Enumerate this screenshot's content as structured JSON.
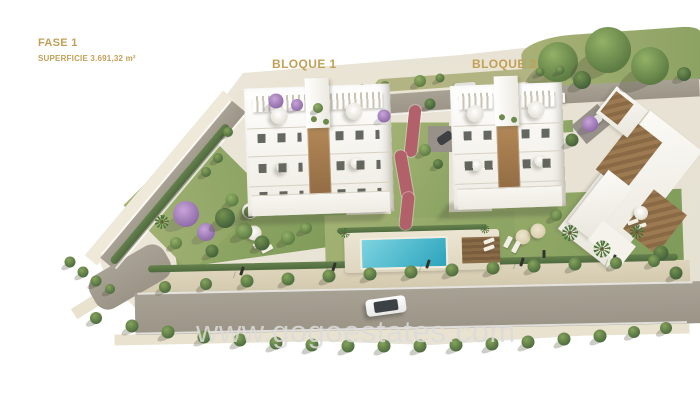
{
  "annotations": {
    "phase": "FASE 1",
    "surface": "SUPERFICIE 3.691,32 m²",
    "block1": "BLOQUE 1",
    "block2": "BLOQUE 2"
  },
  "watermark": {
    "text": "www.gogoestates.com"
  },
  "colors": {
    "accent": "#c2a057",
    "wm": "#dcdcda",
    "pool": "#2ba4bd",
    "road": "#9b9487",
    "lawn": "#7d9a58"
  },
  "scene": {
    "shapes": [
      {
        "c": "terrain",
        "x": 350,
        "y": 200,
        "w": 700,
        "h": 400,
        "r": 0,
        "n": "terrain-base"
      },
      {
        "c": "hill",
        "x": 390,
        "y": 86,
        "w": 310,
        "h": 36,
        "r": -5,
        "n": "hillside"
      },
      {
        "c": "grass-top",
        "x": 612,
        "y": 62,
        "w": 180,
        "h": 60,
        "r": -4,
        "n": "top-grass-area"
      },
      {
        "c": "grass-strip",
        "x": 460,
        "y": 80,
        "w": 170,
        "h": 13,
        "r": -4,
        "n": "roadside-grass"
      },
      {
        "c": "lawn",
        "x": 258,
        "y": 214,
        "w": 175,
        "h": 85,
        "r": -8,
        "n": "left-garden-lawn"
      },
      {
        "c": "lawn2",
        "x": 196,
        "y": 200,
        "w": 110,
        "h": 95,
        "r": -45,
        "n": "left-garden-lawn"
      },
      {
        "c": "lawn",
        "x": 588,
        "y": 238,
        "w": 190,
        "h": 92,
        "r": -2,
        "n": "right-garden-lawn"
      },
      {
        "c": "lawn2",
        "x": 420,
        "y": 236,
        "w": 190,
        "h": 46,
        "r": -1.5,
        "n": "pool-garden-lawn"
      },
      {
        "c": "lawn2",
        "x": 420,
        "y": 170,
        "w": 58,
        "h": 95,
        "r": 0,
        "n": "central-garden"
      },
      {
        "c": "lawn2",
        "x": 300,
        "y": 99,
        "w": 95,
        "h": 14,
        "r": -4,
        "n": "upper-garden-strip"
      },
      {
        "c": "lawn2",
        "x": 543,
        "y": 128,
        "w": 60,
        "h": 12,
        "r": -4,
        "n": "upper-garden-strip"
      },
      {
        "c": "slope",
        "x": 160,
        "y": 178,
        "w": 215,
        "h": 16,
        "r": -50,
        "n": "roadside-slope"
      },
      {
        "c": "sidewalk",
        "x": 415,
        "y": 277,
        "w": 550,
        "h": 22,
        "r": -1.3,
        "n": "sidewalk"
      },
      {
        "c": "shoulder",
        "x": 402,
        "y": 334,
        "w": 575,
        "h": 11,
        "r": -1.2,
        "n": "road-shoulder"
      },
      {
        "c": "shoulder",
        "x": 108,
        "y": 293,
        "w": 80,
        "h": 12,
        "r": -32,
        "n": "road-shoulder"
      },
      {
        "c": "road",
        "x": 173,
        "y": 185,
        "w": 205,
        "h": 18,
        "r": -50,
        "n": "access-road"
      },
      {
        "c": "road road-r",
        "x": 130,
        "y": 277,
        "w": 85,
        "h": 38,
        "r": -30,
        "n": "road-curve"
      },
      {
        "c": "road",
        "x": 420,
        "y": 308,
        "w": 570,
        "h": 42,
        "r": -1.2,
        "n": "main-road"
      },
      {
        "c": "road",
        "x": 450,
        "y": 100,
        "w": 175,
        "h": 20,
        "r": -4,
        "n": "upper-road"
      },
      {
        "c": "road",
        "x": 612,
        "y": 92,
        "w": 175,
        "h": 18,
        "r": -3,
        "n": "upper-road"
      },
      {
        "c": "road",
        "x": 472,
        "y": 130,
        "w": 22,
        "h": 55,
        "r": 4,
        "n": "driveway"
      },
      {
        "c": "road-d",
        "x": 444,
        "y": 139,
        "w": 32,
        "h": 26,
        "r": 0,
        "n": "parking-pad"
      },
      {
        "c": "road-d",
        "x": 592,
        "y": 124,
        "w": 34,
        "h": 24,
        "r": -40,
        "n": "parking-pad"
      },
      {
        "c": "road-line",
        "x": 415,
        "y": 288,
        "w": 555,
        "h": 2,
        "r": -1.2,
        "n": "road-edge-line"
      },
      {
        "c": "road-line",
        "x": 407,
        "y": 328,
        "w": 560,
        "h": 2,
        "r": -1.2,
        "n": "road-edge-line"
      },
      {
        "c": "road-line",
        "x": 166,
        "y": 178,
        "w": 200,
        "h": 2,
        "r": -50,
        "n": "road-edge-line"
      },
      {
        "c": "road-line",
        "x": 180,
        "y": 192,
        "w": 200,
        "h": 2,
        "r": -50,
        "n": "road-edge-line"
      },
      {
        "c": "road-line",
        "x": 450,
        "y": 110,
        "w": 170,
        "h": 2,
        "r": -4,
        "n": "road-edge-line"
      },
      {
        "c": "hedge",
        "x": 413,
        "y": 263,
        "w": 530,
        "h": 7,
        "r": -1.3,
        "n": "perimeter-hedge"
      },
      {
        "c": "hedge",
        "x": 170,
        "y": 194,
        "w": 180,
        "h": 8,
        "r": -50,
        "n": "perimeter-hedge"
      },
      {
        "c": "hedge",
        "x": 412,
        "y": 229,
        "w": 150,
        "h": 6,
        "r": -1.5,
        "n": "pool-hedge"
      },
      {
        "c": "path-red",
        "x": 413,
        "y": 131,
        "w": 12,
        "h": 52,
        "r": 6,
        "n": "garden-path"
      },
      {
        "c": "path-red",
        "x": 404,
        "y": 175,
        "w": 12,
        "h": 50,
        "r": -10,
        "n": "garden-path"
      },
      {
        "c": "path-red",
        "x": 407,
        "y": 211,
        "w": 12,
        "h": 38,
        "r": 6,
        "n": "garden-path"
      },
      {
        "c": "pool-deck",
        "x": 422,
        "y": 251,
        "w": 155,
        "h": 40,
        "r": -1.5,
        "n": "pool-deck"
      },
      {
        "c": "pool-water",
        "x": 404,
        "y": 253,
        "w": 84,
        "h": 28,
        "r": -1.5,
        "n": "swimming-pool"
      },
      {
        "c": "wood-deck",
        "x": 481,
        "y": 250,
        "w": 38,
        "h": 26,
        "r": -1.5,
        "n": "wooden-deck"
      },
      {
        "c": "lounger",
        "x": 489,
        "y": 241,
        "w": 11,
        "h": 4,
        "r": -20,
        "n": "sun-lounger"
      },
      {
        "c": "lounger",
        "x": 489,
        "y": 248,
        "w": 11,
        "h": 4,
        "r": -20,
        "n": "sun-lounger"
      },
      {
        "c": "bwhite",
        "x": 630,
        "y": 190,
        "w": 66,
        "h": 150,
        "r": 38,
        "n": "neighbor-building"
      },
      {
        "c": "broof",
        "x": 629,
        "y": 156,
        "w": 36,
        "h": 62,
        "r": 38,
        "n": "neighbor-building-roof"
      },
      {
        "c": "broof",
        "x": 655,
        "y": 222,
        "w": 42,
        "h": 50,
        "r": 38,
        "n": "neighbor-building-roof"
      },
      {
        "c": "bwhite",
        "x": 600,
        "y": 205,
        "w": 30,
        "h": 66,
        "r": 38,
        "n": "neighbor-building"
      },
      {
        "c": "bwhite2",
        "x": 612,
        "y": 243,
        "w": 42,
        "h": 24,
        "r": 38,
        "n": "neighbor-terrace"
      },
      {
        "c": "bwhite",
        "x": 622,
        "y": 112,
        "w": 40,
        "h": 34,
        "r": 38,
        "n": "neighbor-building"
      },
      {
        "c": "broof",
        "x": 617,
        "y": 108,
        "w": 22,
        "h": 26,
        "r": 38,
        "n": "neighbor-building-roof"
      },
      {
        "c": "wall-tan",
        "x": 549,
        "y": 115,
        "w": 9,
        "h": 26,
        "r": 0,
        "n": "boundary-wall"
      },
      {
        "c": "perg-dark",
        "x": 553,
        "y": 128,
        "w": 16,
        "h": 12,
        "r": 0,
        "n": "carport"
      },
      {
        "c": "walk",
        "x": 282,
        "y": 98,
        "w": 62,
        "h": 11,
        "r": -4,
        "n": "rooftop-walkway"
      },
      {
        "c": "walk",
        "x": 540,
        "y": 99,
        "w": 50,
        "h": 10,
        "r": -3,
        "n": "rooftop-walkway"
      },
      {
        "c": "car-gray",
        "x": 372,
        "y": 112,
        "w": 22,
        "h": 9,
        "r": -8,
        "n": "parked-car"
      },
      {
        "c": "car-gray",
        "x": 465,
        "y": 87,
        "w": 22,
        "h": 9,
        "r": -4,
        "n": "parked-car"
      },
      {
        "c": "car-gray2",
        "x": 487,
        "y": 90,
        "w": 20,
        "h": 8,
        "r": -4,
        "n": "parked-car"
      },
      {
        "c": "car-dark",
        "x": 445,
        "y": 138,
        "w": 16,
        "h": 9,
        "r": -35,
        "n": "parked-car"
      },
      {
        "c": "car-gray",
        "x": 594,
        "y": 122,
        "w": 18,
        "h": 8,
        "r": -40,
        "n": "parked-car"
      },
      {
        "c": "lamp",
        "x": 242,
        "y": 271,
        "w": 3,
        "h": 9,
        "r": 18,
        "n": "street-lamp"
      },
      {
        "c": "lamp",
        "x": 334,
        "y": 267,
        "w": 3,
        "h": 9,
        "r": 18,
        "n": "street-lamp"
      },
      {
        "c": "lamp",
        "x": 428,
        "y": 264,
        "w": 3,
        "h": 9,
        "r": 18,
        "n": "street-lamp"
      },
      {
        "c": "lamp",
        "x": 522,
        "y": 262,
        "w": 3,
        "h": 9,
        "r": 18,
        "n": "street-lamp"
      },
      {
        "c": "lamp",
        "x": 614,
        "y": 259,
        "w": 3,
        "h": 9,
        "r": 18,
        "n": "street-lamp"
      },
      {
        "c": "lamp",
        "x": 544,
        "y": 254,
        "w": 3,
        "h": 8,
        "r": 0,
        "n": "garden-shower"
      },
      {
        "c": "parasol",
        "x": 250,
        "y": 211,
        "w": 16,
        "h": 16,
        "r": 0,
        "n": "parasol"
      },
      {
        "c": "parasol",
        "x": 254,
        "y": 233,
        "w": 15,
        "h": 15,
        "r": 0,
        "n": "parasol"
      },
      {
        "c": "parasol-b",
        "x": 523,
        "y": 237,
        "w": 15,
        "h": 15,
        "r": 0,
        "n": "parasol"
      },
      {
        "c": "parasol-b",
        "x": 538,
        "y": 231,
        "w": 15,
        "h": 15,
        "r": 0,
        "n": "parasol"
      },
      {
        "c": "parasol",
        "x": 641,
        "y": 213,
        "w": 14,
        "h": 14,
        "r": 0,
        "n": "parasol"
      },
      {
        "c": "lounger",
        "x": 259,
        "y": 244,
        "w": 12,
        "h": 5,
        "r": -28,
        "n": "sun-lounger"
      },
      {
        "c": "lounger",
        "x": 267,
        "y": 249,
        "w": 12,
        "h": 5,
        "r": -28,
        "n": "sun-lounger"
      },
      {
        "c": "lounger",
        "x": 508,
        "y": 242,
        "w": 12,
        "h": 5,
        "r": -62,
        "n": "sun-lounger"
      },
      {
        "c": "lounger",
        "x": 516,
        "y": 247,
        "w": 12,
        "h": 5,
        "r": -62,
        "n": "sun-lounger"
      },
      {
        "c": "lounger",
        "x": 633,
        "y": 222,
        "w": 11,
        "h": 4,
        "r": -20,
        "n": "sun-lounger"
      },
      {
        "c": "lounger",
        "x": 641,
        "y": 226,
        "w": 11,
        "h": 4,
        "r": -20,
        "n": "sun-lounger"
      },
      {
        "c": "car-white",
        "x": 386,
        "y": 306,
        "w": 40,
        "h": 17,
        "r": -8,
        "n": "driving-car"
      }
    ],
    "trees": [
      {
        "t": "g",
        "x": 558,
        "y": 62,
        "s": 40
      },
      {
        "t": "g",
        "x": 608,
        "y": 50,
        "s": 46
      },
      {
        "t": "g",
        "x": 650,
        "y": 66,
        "s": 38
      },
      {
        "t": "d",
        "x": 582,
        "y": 80,
        "s": 18
      },
      {
        "t": "d",
        "x": 684,
        "y": 74,
        "s": 14
      },
      {
        "t": "s",
        "x": 340,
        "y": 93,
        "s": 10
      },
      {
        "t": "s",
        "x": 362,
        "y": 89,
        "s": 10
      },
      {
        "t": "s",
        "x": 385,
        "y": 86,
        "s": 10
      },
      {
        "t": "g",
        "x": 420,
        "y": 81,
        "s": 12
      },
      {
        "t": "s",
        "x": 440,
        "y": 78,
        "s": 9
      },
      {
        "t": "s",
        "x": 540,
        "y": 72,
        "s": 9
      },
      {
        "t": "s",
        "x": 560,
        "y": 70,
        "s": 9
      },
      {
        "t": "g",
        "x": 425,
        "y": 150,
        "s": 12
      },
      {
        "t": "d",
        "x": 438,
        "y": 164,
        "s": 10
      },
      {
        "t": "p",
        "x": 186,
        "y": 214,
        "s": 26
      },
      {
        "t": "p",
        "x": 206,
        "y": 232,
        "s": 18
      },
      {
        "t": "d",
        "x": 225,
        "y": 218,
        "s": 20
      },
      {
        "t": "g",
        "x": 244,
        "y": 231,
        "s": 17
      },
      {
        "t": "d",
        "x": 262,
        "y": 243,
        "s": 15
      },
      {
        "t": "g",
        "x": 288,
        "y": 238,
        "s": 14
      },
      {
        "t": "g",
        "x": 306,
        "y": 228,
        "s": 12
      },
      {
        "t": "d",
        "x": 212,
        "y": 251,
        "s": 13
      },
      {
        "t": "m",
        "x": 162,
        "y": 222,
        "s": 14
      },
      {
        "t": "g",
        "x": 176,
        "y": 243,
        "s": 12
      },
      {
        "t": "g",
        "x": 232,
        "y": 200,
        "s": 13
      },
      {
        "t": "d",
        "x": 250,
        "y": 212,
        "s": 12
      },
      {
        "t": "m",
        "x": 570,
        "y": 233,
        "s": 16
      },
      {
        "t": "m",
        "x": 602,
        "y": 249,
        "s": 17
      },
      {
        "t": "m",
        "x": 637,
        "y": 232,
        "s": 14
      },
      {
        "t": "d",
        "x": 661,
        "y": 253,
        "s": 15
      },
      {
        "t": "g",
        "x": 556,
        "y": 215,
        "s": 12
      },
      {
        "t": "d",
        "x": 676,
        "y": 273,
        "s": 13
      },
      {
        "t": "m",
        "x": 345,
        "y": 233,
        "s": 10
      },
      {
        "t": "m",
        "x": 485,
        "y": 229,
        "s": 9
      },
      {
        "t": "s",
        "x": 70,
        "y": 262,
        "s": 11
      },
      {
        "t": "s",
        "x": 83,
        "y": 272,
        "s": 11
      },
      {
        "t": "s",
        "x": 96,
        "y": 281,
        "s": 11
      },
      {
        "t": "s",
        "x": 110,
        "y": 289,
        "s": 10
      },
      {
        "t": "s",
        "x": 218,
        "y": 158,
        "s": 10
      },
      {
        "t": "s",
        "x": 206,
        "y": 172,
        "s": 10
      },
      {
        "t": "s",
        "x": 228,
        "y": 132,
        "s": 10
      },
      {
        "t": "s",
        "x": 165,
        "y": 287,
        "s": 12
      },
      {
        "t": "s",
        "x": 206,
        "y": 284,
        "s": 12
      },
      {
        "t": "s",
        "x": 247,
        "y": 281,
        "s": 13
      },
      {
        "t": "s",
        "x": 288,
        "y": 279,
        "s": 13
      },
      {
        "t": "s",
        "x": 329,
        "y": 276,
        "s": 13
      },
      {
        "t": "s",
        "x": 370,
        "y": 274,
        "s": 13
      },
      {
        "t": "s",
        "x": 411,
        "y": 272,
        "s": 13
      },
      {
        "t": "s",
        "x": 452,
        "y": 270,
        "s": 13
      },
      {
        "t": "s",
        "x": 493,
        "y": 268,
        "s": 13
      },
      {
        "t": "s",
        "x": 534,
        "y": 266,
        "s": 13
      },
      {
        "t": "s",
        "x": 575,
        "y": 264,
        "s": 13
      },
      {
        "t": "s",
        "x": 616,
        "y": 263,
        "s": 12
      },
      {
        "t": "s",
        "x": 654,
        "y": 261,
        "s": 12
      },
      {
        "t": "s",
        "x": 96,
        "y": 318,
        "s": 12
      },
      {
        "t": "s",
        "x": 132,
        "y": 326,
        "s": 13
      },
      {
        "t": "s",
        "x": 168,
        "y": 332,
        "s": 13
      },
      {
        "t": "s",
        "x": 204,
        "y": 337,
        "s": 13
      },
      {
        "t": "s",
        "x": 240,
        "y": 340,
        "s": 13
      },
      {
        "t": "s",
        "x": 276,
        "y": 343,
        "s": 13
      },
      {
        "t": "s",
        "x": 312,
        "y": 345,
        "s": 13
      },
      {
        "t": "s",
        "x": 348,
        "y": 346,
        "s": 13
      },
      {
        "t": "s",
        "x": 384,
        "y": 346,
        "s": 13
      },
      {
        "t": "s",
        "x": 420,
        "y": 346,
        "s": 13
      },
      {
        "t": "s",
        "x": 456,
        "y": 345,
        "s": 13
      },
      {
        "t": "s",
        "x": 492,
        "y": 344,
        "s": 13
      },
      {
        "t": "s",
        "x": 528,
        "y": 342,
        "s": 13
      },
      {
        "t": "s",
        "x": 564,
        "y": 339,
        "s": 13
      },
      {
        "t": "s",
        "x": 600,
        "y": 336,
        "s": 13
      },
      {
        "t": "s",
        "x": 634,
        "y": 332,
        "s": 12
      },
      {
        "t": "s",
        "x": 666,
        "y": 328,
        "s": 12
      }
    ],
    "trees_top": [
      {
        "t": "p",
        "x": 276,
        "y": 101,
        "s": 15
      },
      {
        "t": "p",
        "x": 297,
        "y": 105,
        "s": 12
      },
      {
        "t": "g",
        "x": 318,
        "y": 108,
        "s": 10
      },
      {
        "t": "p",
        "x": 384,
        "y": 116,
        "s": 13
      },
      {
        "t": "p",
        "x": 590,
        "y": 124,
        "s": 16
      },
      {
        "t": "d",
        "x": 572,
        "y": 140,
        "s": 13
      },
      {
        "t": "d",
        "x": 430,
        "y": 104,
        "s": 11
      }
    ]
  }
}
